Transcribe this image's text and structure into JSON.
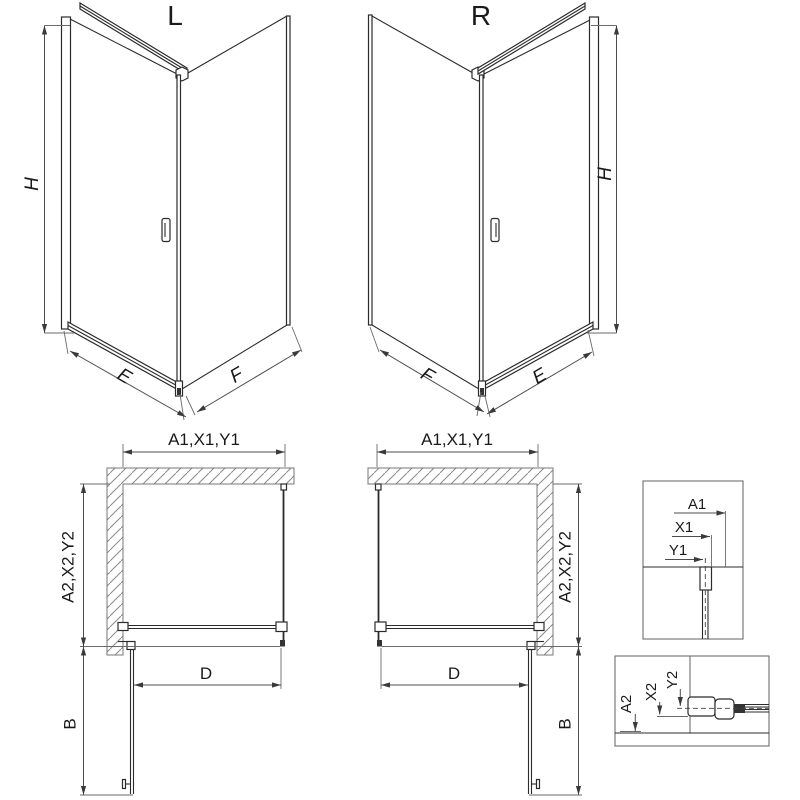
{
  "views": {
    "iso_left": {
      "title": "L",
      "dim_height": "H",
      "dim_front_width": "E",
      "dim_side_width": "F"
    },
    "iso_right": {
      "title": "R",
      "dim_height": "H",
      "dim_front_width": "E",
      "dim_side_width": "F"
    },
    "plan_left": {
      "dim_width": "A1,X1,Y1",
      "dim_depth": "A2,X2,Y2",
      "dim_opening": "D",
      "dim_door_swing": "B"
    },
    "plan_right": {
      "dim_width": "A1,X1,Y1",
      "dim_depth": "A2,X2,Y2",
      "dim_opening": "D",
      "dim_door_swing": "B"
    },
    "detail_width_refs": {
      "dim_outer": "A1",
      "dim_profile": "X1",
      "dim_glass_axis": "Y1"
    },
    "detail_depth_refs": {
      "dim_outer": "A2",
      "dim_profile": "X2",
      "dim_glass_axis": "Y2"
    }
  },
  "colors": {
    "background": "#ffffff",
    "structure_line": "#2b2b2b",
    "dimension_line": "#4d4d4d",
    "hatch_line": "#8a8a8a"
  }
}
